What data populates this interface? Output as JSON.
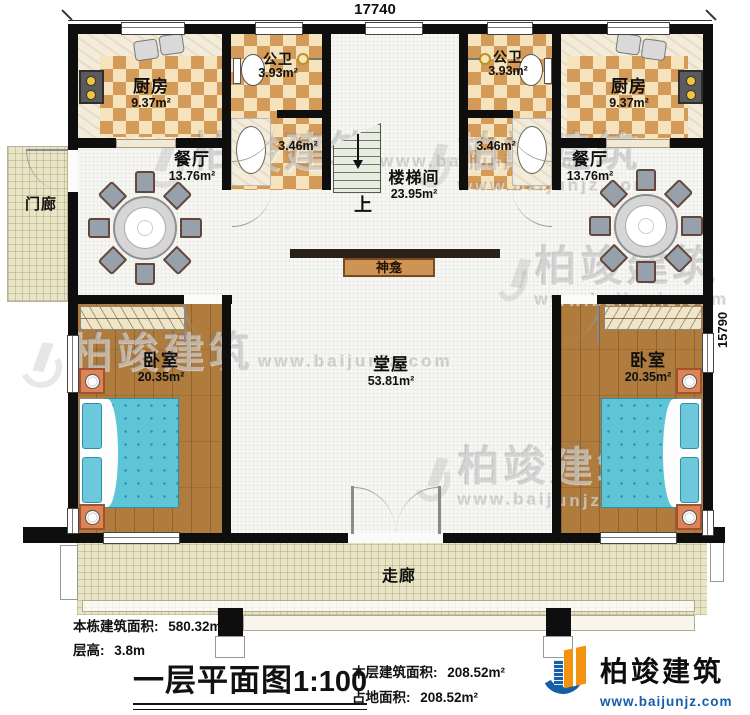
{
  "dimensions": {
    "width": "17740",
    "height": "15790"
  },
  "rooms": {
    "kitchen_left": {
      "name": "厨房",
      "area": "9.37m²"
    },
    "kitchen_right": {
      "name": "厨房",
      "area": "9.37m²"
    },
    "bath_left": {
      "name": "公卫",
      "area": "3.93m²"
    },
    "bath_right": {
      "name": "公卫",
      "area": "3.93m²"
    },
    "wash_left": {
      "area": "3.46m²"
    },
    "wash_right": {
      "area": "3.46m²"
    },
    "dining_left": {
      "name": "餐厅",
      "area": "13.76m²"
    },
    "dining_right": {
      "name": "餐厅",
      "area": "13.76m²"
    },
    "stairwell": {
      "name": "楼梯间",
      "area": "23.95m²",
      "up": "上"
    },
    "hall": {
      "name": "堂屋",
      "area": "53.81m²"
    },
    "shrine": {
      "name": "神龛"
    },
    "bedroom_left": {
      "name": "卧室",
      "area": "20.35m²"
    },
    "bedroom_right": {
      "name": "卧室",
      "area": "20.35m²"
    },
    "porch": {
      "name": "门廊"
    },
    "corridor": {
      "name": "走廊"
    }
  },
  "footer": {
    "building_area_label": "本栋建筑面积:",
    "building_area_value": "580.32m²",
    "floor_height_label": "层高:",
    "floor_height_value": "3.8m",
    "title": "一层平面图",
    "scale": "1:100",
    "floor_area_label": "本层建筑面积:",
    "floor_area_value": "208.52m²",
    "footprint_label": "占地面积:",
    "footprint_value": "208.52m²"
  },
  "brand": {
    "name": "柏竣建筑",
    "website": "www.baijunjz.com"
  },
  "watermark": {
    "name": "柏竣建筑",
    "website": "www.baijunjz.com"
  },
  "colors": {
    "wall": "#0e0e0e",
    "brand_blue": "#155fa8",
    "brand_orange": "#f3920f",
    "bed": "#5ec4d8",
    "checker": "#d49a57",
    "wood": "#b07c3e"
  },
  "icons": {
    "brand_logo": "building-swoosh-icon",
    "stair_arrow": "up-direction-arrow-icon"
  }
}
